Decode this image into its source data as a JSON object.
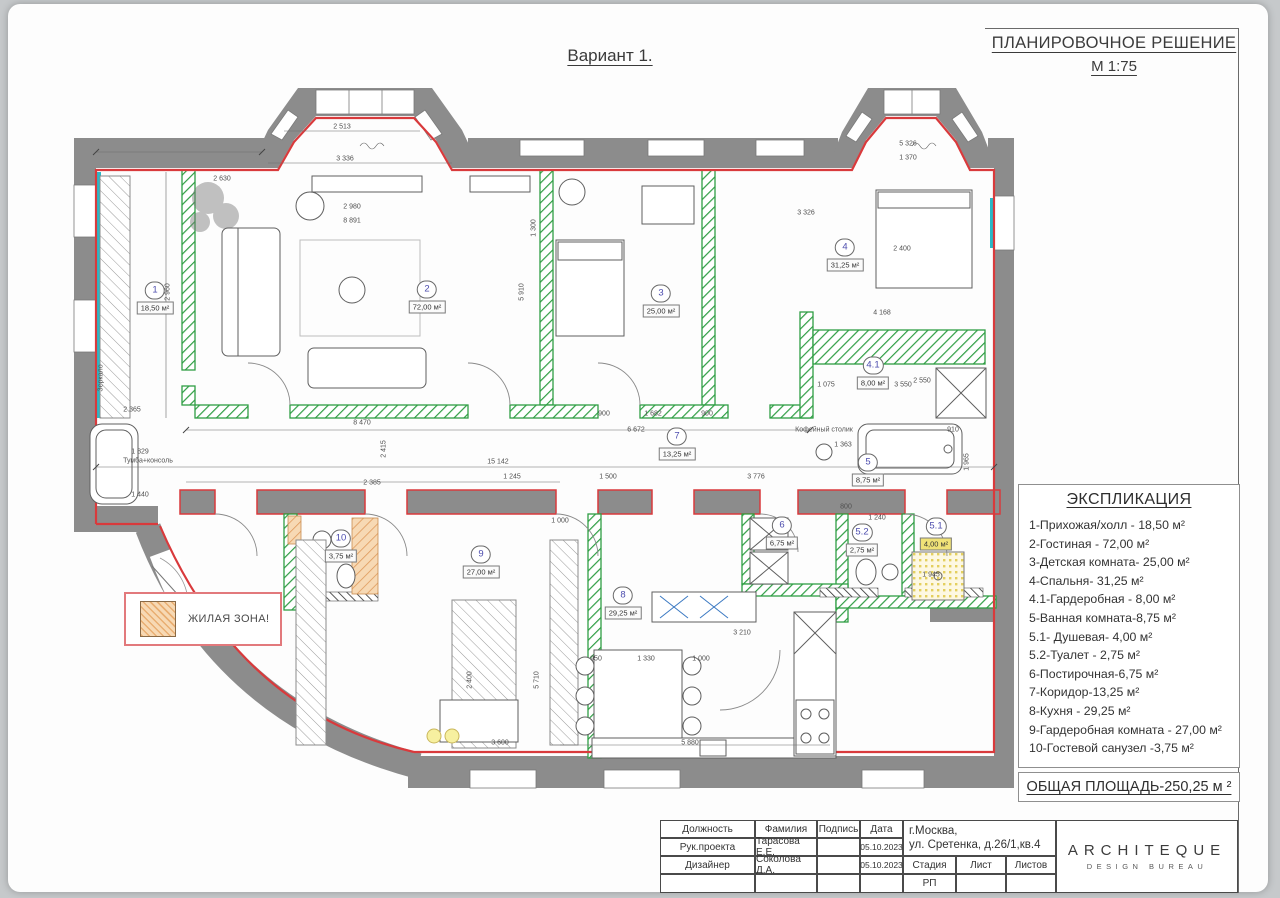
{
  "page": {
    "variant_title": "Вариант 1.",
    "drawing_title": "ПЛАНИРОВОЧНОЕ РЕШЕНИЕ",
    "scale": "М 1:75"
  },
  "legend": {
    "zone_label": "ЖИЛАЯ ЗОНА!"
  },
  "explication": {
    "title": "ЭКСПЛИКАЦИЯ",
    "items": [
      "1-Прихожая/холл - 18,50 м²",
      "2-Гостиная - 72,00 м²",
      "3-Детская комната- 25,00 м²",
      "4-Спальня- 31,25 м²",
      "4.1-Гардеробная - 8,00 м²",
      "5-Ванная комната-8,75 м²",
      "5.1- Душевая- 4,00 м²",
      "5.2-Туалет - 2,75 м²",
      "6-Постирочная-6,75 м²",
      "7-Коридор-13,25 м²",
      "8-Кухня - 29,25 м²",
      "9-Гардеробная комната - 27,00 м²",
      "10-Гостевой санузел -3,75 м²"
    ],
    "total": "ОБЩАЯ ПЛОЩАДЬ-250,25 м ²"
  },
  "rooms": [
    {
      "num": "1",
      "area": "18,50 м²",
      "x": 155,
      "y": 298
    },
    {
      "num": "2",
      "area": "72,00 м²",
      "x": 427,
      "y": 297
    },
    {
      "num": "3",
      "area": "25,00 м²",
      "x": 661,
      "y": 301
    },
    {
      "num": "4",
      "area": "31,25 м²",
      "x": 845,
      "y": 255
    },
    {
      "num": "4.1",
      "area": "8,00 м²",
      "x": 873,
      "y": 373
    },
    {
      "num": "5",
      "area": "8,75 м²",
      "x": 868,
      "y": 470
    },
    {
      "num": "5.1",
      "area": "4,00 м²",
      "x": 936,
      "y": 534,
      "hl": true
    },
    {
      "num": "5.2",
      "area": "2,75 м²",
      "x": 862,
      "y": 540
    },
    {
      "num": "6",
      "area": "6,75 м²",
      "x": 782,
      "y": 533
    },
    {
      "num": "7",
      "area": "13,25 м²",
      "x": 677,
      "y": 444
    },
    {
      "num": "8",
      "area": "29,25 м²",
      "x": 623,
      "y": 603
    },
    {
      "num": "9",
      "area": "27,00 м²",
      "x": 481,
      "y": 562
    },
    {
      "num": "10",
      "area": "3,75 м²",
      "x": 341,
      "y": 546
    }
  ],
  "plan_labels": [
    {
      "t": "Зеркало",
      "x": 101,
      "y": 378,
      "r": 90
    },
    {
      "t": "Тумба+консоль",
      "x": 148,
      "y": 461
    },
    {
      "t": "Кофейный столик",
      "x": 824,
      "y": 430
    }
  ],
  "dimensions": [
    {
      "t": "2 513",
      "x": 342,
      "y": 127
    },
    {
      "t": "3 336",
      "x": 345,
      "y": 159
    },
    {
      "t": "2 630",
      "x": 222,
      "y": 179
    },
    {
      "t": "2 980",
      "x": 352,
      "y": 207
    },
    {
      "t": "8 891",
      "x": 352,
      "y": 221
    },
    {
      "t": "1 300",
      "x": 534,
      "y": 228,
      "r": 1
    },
    {
      "t": "5 326",
      "x": 908,
      "y": 144
    },
    {
      "t": "1 370",
      "x": 908,
      "y": 158
    },
    {
      "t": "2 400",
      "x": 902,
      "y": 249
    },
    {
      "t": "3 326",
      "x": 806,
      "y": 213
    },
    {
      "t": "4 168",
      "x": 882,
      "y": 313
    },
    {
      "t": "2 960",
      "x": 168,
      "y": 292,
      "r": 1
    },
    {
      "t": "5 910",
      "x": 522,
      "y": 292,
      "r": 1
    },
    {
      "t": "8 470",
      "x": 362,
      "y": 423
    },
    {
      "t": "15 142",
      "x": 498,
      "y": 462
    },
    {
      "t": "2 415",
      "x": 384,
      "y": 449,
      "r": 1
    },
    {
      "t": "6 672",
      "x": 636,
      "y": 430
    },
    {
      "t": "900",
      "x": 604,
      "y": 414
    },
    {
      "t": "1 682",
      "x": 653,
      "y": 414
    },
    {
      "t": "900",
      "x": 707,
      "y": 414
    },
    {
      "t": "1 245",
      "x": 512,
      "y": 477
    },
    {
      "t": "1 500",
      "x": 608,
      "y": 477
    },
    {
      "t": "3 776",
      "x": 756,
      "y": 477
    },
    {
      "t": "2 385",
      "x": 372,
      "y": 483
    },
    {
      "t": "1 440",
      "x": 140,
      "y": 495
    },
    {
      "t": "1 829",
      "x": 140,
      "y": 452
    },
    {
      "t": "2 365",
      "x": 132,
      "y": 410
    },
    {
      "t": "1 000",
      "x": 560,
      "y": 521
    },
    {
      "t": "800",
      "x": 846,
      "y": 507
    },
    {
      "t": "1 240",
      "x": 877,
      "y": 518
    },
    {
      "t": "1 363",
      "x": 843,
      "y": 445
    },
    {
      "t": "910",
      "x": 953,
      "y": 430
    },
    {
      "t": "1 965",
      "x": 967,
      "y": 462,
      "r": 1
    },
    {
      "t": "1 945",
      "x": 931,
      "y": 575
    },
    {
      "t": "2 550",
      "x": 922,
      "y": 381
    },
    {
      "t": "1 075",
      "x": 826,
      "y": 385
    },
    {
      "t": "3 550",
      "x": 903,
      "y": 385
    },
    {
      "t": "2 520",
      "x": 622,
      "y": 615
    },
    {
      "t": "3 210",
      "x": 742,
      "y": 633
    },
    {
      "t": "950",
      "x": 596,
      "y": 659
    },
    {
      "t": "1 330",
      "x": 646,
      "y": 659
    },
    {
      "t": "1 000",
      "x": 701,
      "y": 659
    },
    {
      "t": "5 880",
      "x": 690,
      "y": 743
    },
    {
      "t": "3 600",
      "x": 500,
      "y": 743
    },
    {
      "t": "5 710",
      "x": 537,
      "y": 680,
      "r": 1
    },
    {
      "t": "2 400",
      "x": 470,
      "y": 680,
      "r": 1
    }
  ],
  "title_block": {
    "headers": [
      "Должность",
      "Фамилия",
      "Подпись",
      "Дата"
    ],
    "row1": [
      "Рук.проекта",
      "Тарасова Е.Е.",
      "",
      "05.10.2023"
    ],
    "row2": [
      "Дизайнер",
      "Соколова Д.А.",
      "",
      "05.10.2023"
    ],
    "address1": "г.Москва,",
    "address2": "ул. Сретенка, д.26/1,кв.4",
    "stage_header": "Стадия",
    "sheet_header": "Лист",
    "sheets_header": "Листов",
    "stage_value": "РП",
    "logo_top": "ARCHITEQUE",
    "logo_bottom": "DESIGN BUREAU"
  },
  "colors": {
    "wall_red": "#d93a3c",
    "wall_green": "#2f9e44",
    "glazing_teal": "#2bb8c6",
    "zone_orange": "#f3c99b",
    "wall_gray": "#8c8c8c",
    "highlight_yellow": "#f0e277"
  }
}
